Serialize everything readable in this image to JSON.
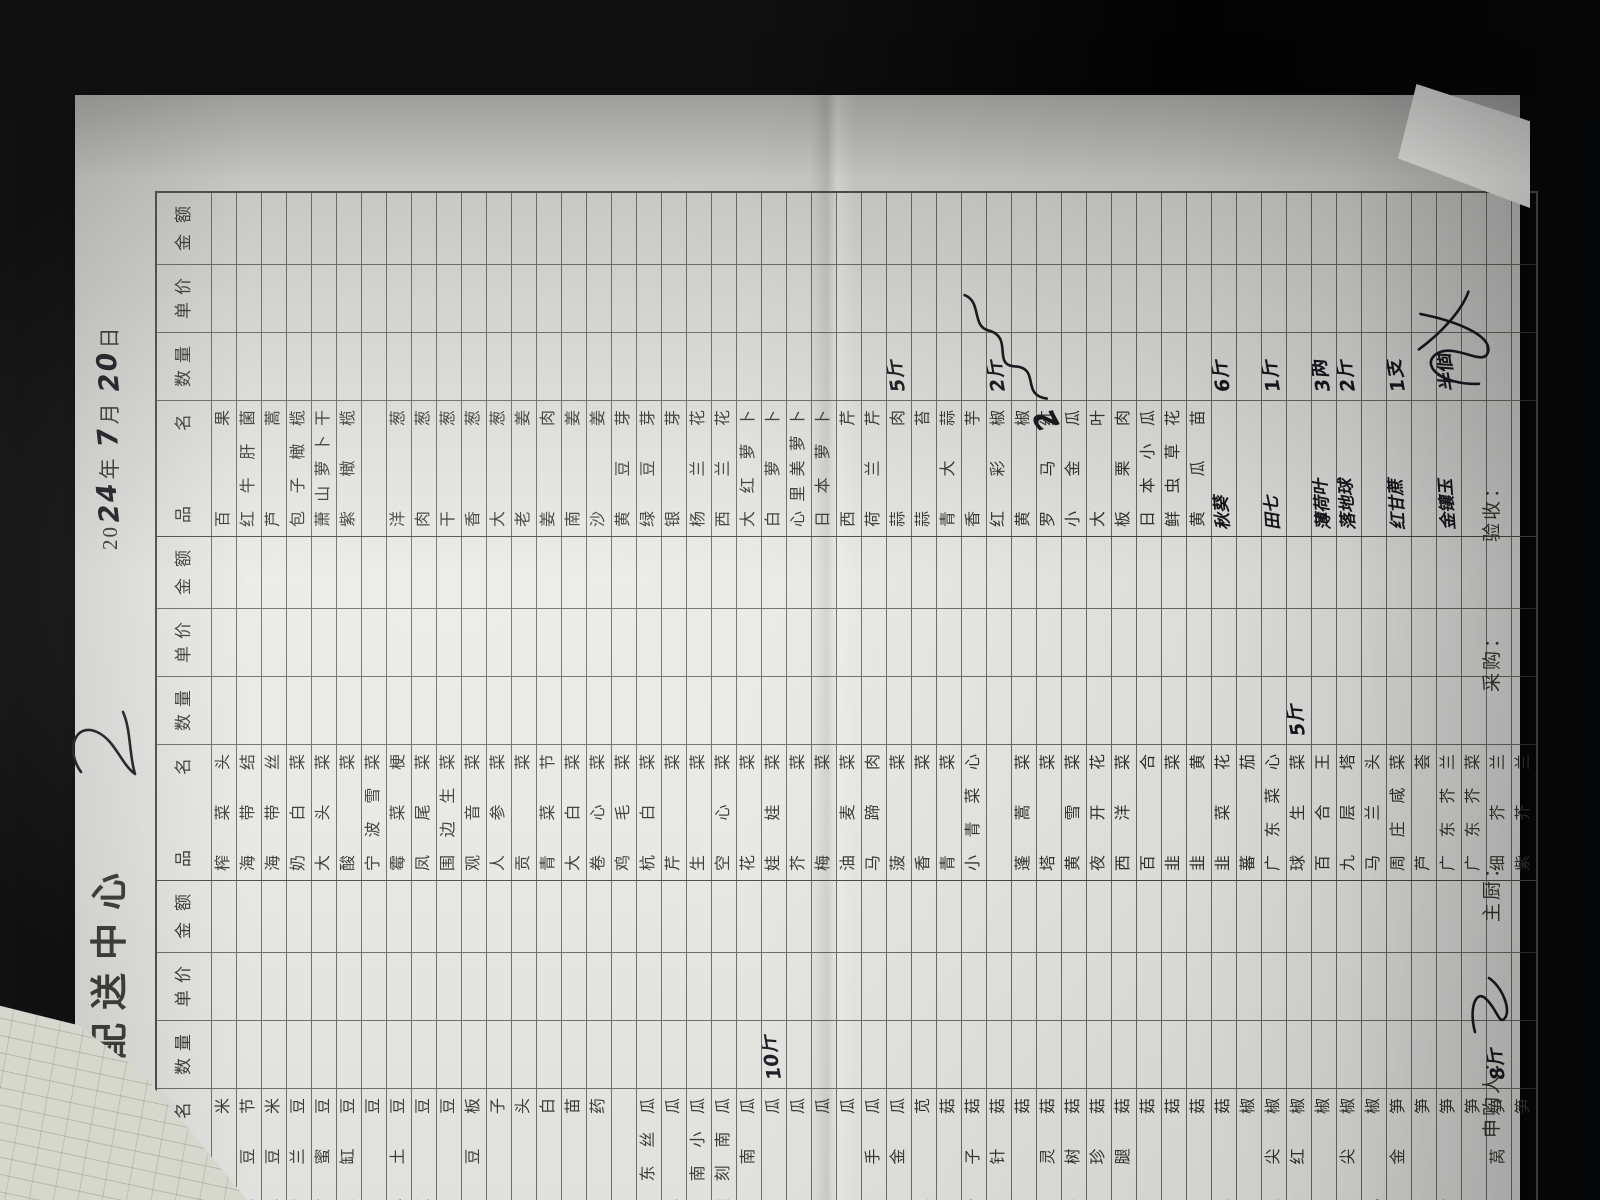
{
  "header": {
    "title": "蔬菜配送中心",
    "date": {
      "p1": "20",
      "hw_year": "24",
      "y": "年",
      "hw_month": "7",
      "m": "月",
      "hw_day": "20",
      "d": "日"
    }
  },
  "table": {
    "columns": [
      "品 名",
      "数 量",
      "单 价",
      "金 额"
    ],
    "groups": [
      {
        "id": "left",
        "items": [
          {
            "n": "玉米"
          },
          {
            "n": "毛豆节"
          },
          {
            "n": "毛豆米"
          },
          {
            "n": "荷兰豆"
          },
          {
            "n": "甜蜜豆"
          },
          {
            "n": "酸缸豆"
          },
          {
            "n": "土豆"
          },
          {
            "n": "小土豆"
          },
          {
            "n": "缸豆"
          },
          {
            "n": "刀豆"
          },
          {
            "n": "青豆板"
          },
          {
            "n": "茄子"
          },
          {
            "n": "草头"
          },
          {
            "n": "茭白"
          },
          {
            "n": "豆苗"
          },
          {
            "n": "山药"
          },
          {
            "n": "藕"
          },
          {
            "n": "广东丝瓜"
          },
          {
            "n": "地瓜"
          },
          {
            "n": "云南小瓜"
          },
          {
            "n": "雕刻南瓜"
          },
          {
            "n": "老南瓜"
          },
          {
            "n": "黄瓜",
            "q": "10斤"
          },
          {
            "n": "冬瓜"
          },
          {
            "n": "丝瓜"
          },
          {
            "n": "苦瓜"
          },
          {
            "n": "佛手瓜"
          },
          {
            "n": "黄金瓜"
          },
          {
            "n": "米苋"
          },
          {
            "n": "香菇"
          },
          {
            "n": "滑子菇"
          },
          {
            "n": "金针菇"
          },
          {
            "n": "平菇"
          },
          {
            "n": "白灵菇"
          },
          {
            "n": "茶树菇"
          },
          {
            "n": "秀珍菇"
          },
          {
            "n": "鸡腿菇"
          },
          {
            "n": "香菇"
          },
          {
            "n": "蘑菇"
          },
          {
            "n": "草菇"
          },
          {
            "n": "姬菇"
          },
          {
            "n": "黄椒"
          },
          {
            "n": "红尖椒"
          },
          {
            "n": "大红椒"
          },
          {
            "n": "青椒"
          },
          {
            "n": "青尖椒"
          },
          {
            "n": "杭椒"
          },
          {
            "n": "黄金笋"
          },
          {
            "n": "冬笋"
          },
          {
            "n": "竹笋"
          },
          {
            "n": "芦笋"
          },
          {
            "n": "香莴笋",
            "q": "8斤"
          },
          {
            "n": "水笋"
          }
        ]
      },
      {
        "id": "middle",
        "items": [
          {
            "n": "榨菜头"
          },
          {
            "n": "海带结"
          },
          {
            "n": "海带丝"
          },
          {
            "n": "奶白菜"
          },
          {
            "n": "大头菜"
          },
          {
            "n": "酸菜"
          },
          {
            "n": "宁波雪菜"
          },
          {
            "n": "霉菜梗"
          },
          {
            "n": "凤尾菜"
          },
          {
            "n": "围边生菜"
          },
          {
            "n": "观音菜"
          },
          {
            "n": "人参菜"
          },
          {
            "n": "贡菜"
          },
          {
            "n": "青菜节"
          },
          {
            "n": "大白菜"
          },
          {
            "n": "卷心菜"
          },
          {
            "n": "鸡毛菜"
          },
          {
            "n": "杭白菜"
          },
          {
            "n": "芹菜"
          },
          {
            "n": "生菜"
          },
          {
            "n": "空心菜"
          },
          {
            "n": "花菜"
          },
          {
            "n": "娃娃菜"
          },
          {
            "n": "芥菜"
          },
          {
            "n": "梅菜"
          },
          {
            "n": "油麦菜"
          },
          {
            "n": "马蹄肉"
          },
          {
            "n": "菠菜"
          },
          {
            "n": "香菜"
          },
          {
            "n": "青菜"
          },
          {
            "n": "小青菜心"
          },
          {
            "n": ""
          },
          {
            "n": "蓬蒿菜"
          },
          {
            "n": "塔菜"
          },
          {
            "n": "黄雪菜"
          },
          {
            "n": "夜开花"
          },
          {
            "n": "西洋菜"
          },
          {
            "n": "百合"
          },
          {
            "n": "韭菜"
          },
          {
            "n": "韭黄"
          },
          {
            "n": "韭菜花"
          },
          {
            "n": "蕃茄"
          },
          {
            "n": "广东菜心"
          },
          {
            "n": "球生菜",
            "q": "5斤"
          },
          {
            "n": "百合王"
          },
          {
            "n": "九层塔"
          },
          {
            "n": "马兰头"
          },
          {
            "n": "周庄咸菜"
          },
          {
            "n": "芦荟"
          },
          {
            "n": "广东芥兰"
          },
          {
            "n": "广东芥菜"
          },
          {
            "n": "细芥兰"
          },
          {
            "n": "紫芥兰"
          }
        ]
      },
      {
        "id": "right",
        "items": [
          {
            "n": "百果"
          },
          {
            "n": "红牛肝菌"
          },
          {
            "n": "芦蒿"
          },
          {
            "n": "包子橄榄"
          },
          {
            "n": "萧山萝卜干"
          },
          {
            "n": "紫橄榄"
          },
          {
            "n": ""
          },
          {
            "n": "洋葱"
          },
          {
            "n": "肉葱"
          },
          {
            "n": "干葱"
          },
          {
            "n": "香葱"
          },
          {
            "n": "大葱"
          },
          {
            "n": "老姜"
          },
          {
            "n": "姜肉"
          },
          {
            "n": "南姜"
          },
          {
            "n": "沙姜"
          },
          {
            "n": "黄豆芽"
          },
          {
            "n": "绿豆芽"
          },
          {
            "n": "银芽"
          },
          {
            "n": "杨兰花"
          },
          {
            "n": "西兰花"
          },
          {
            "n": "大红萝卜"
          },
          {
            "n": "白萝卜"
          },
          {
            "n": "心里美萝卜"
          },
          {
            "n": "日本萝卜"
          },
          {
            "n": "西芹"
          },
          {
            "n": "荷兰芹"
          },
          {
            "n": "蒜肉",
            "q": "5斤"
          },
          {
            "n": "蒜苔"
          },
          {
            "n": "青大蒜"
          },
          {
            "n": "香芋"
          },
          {
            "n": "红彩椒",
            "q": "2斤"
          },
          {
            "n": "黄椒"
          },
          {
            "n": "罗马红"
          },
          {
            "n": "小金瓜"
          },
          {
            "n": "大叶"
          },
          {
            "n": "板栗肉"
          },
          {
            "n": "日本小瓜"
          },
          {
            "n": "鲜虫草花"
          },
          {
            "n": "黄瓜苗"
          },
          {
            "n": "秋葵",
            "q": "6斤",
            "hw": true
          },
          {
            "n": ""
          },
          {
            "n": "田七",
            "q": "1斤",
            "hw": true
          },
          {
            "n": ""
          },
          {
            "n": "薄荷叶",
            "q": "3两",
            "hw": true
          },
          {
            "n": "落地球",
            "q": "2斤",
            "hw": true
          },
          {
            "n": ""
          },
          {
            "n": "红甘蔗",
            "q": "1支",
            "hw": true
          },
          {
            "n": ""
          },
          {
            "n": "金镶玉",
            "q": "半個",
            "hw": true
          },
          {
            "n": ""
          },
          {
            "n": ""
          },
          {
            "n": ""
          }
        ]
      }
    ]
  },
  "annotations": {
    "daye_note": "2"
  },
  "footer": {
    "items": [
      {
        "label": "申购人："
      },
      {
        "label": "主厨："
      },
      {
        "label": "采购："
      },
      {
        "label": "验收："
      }
    ]
  }
}
